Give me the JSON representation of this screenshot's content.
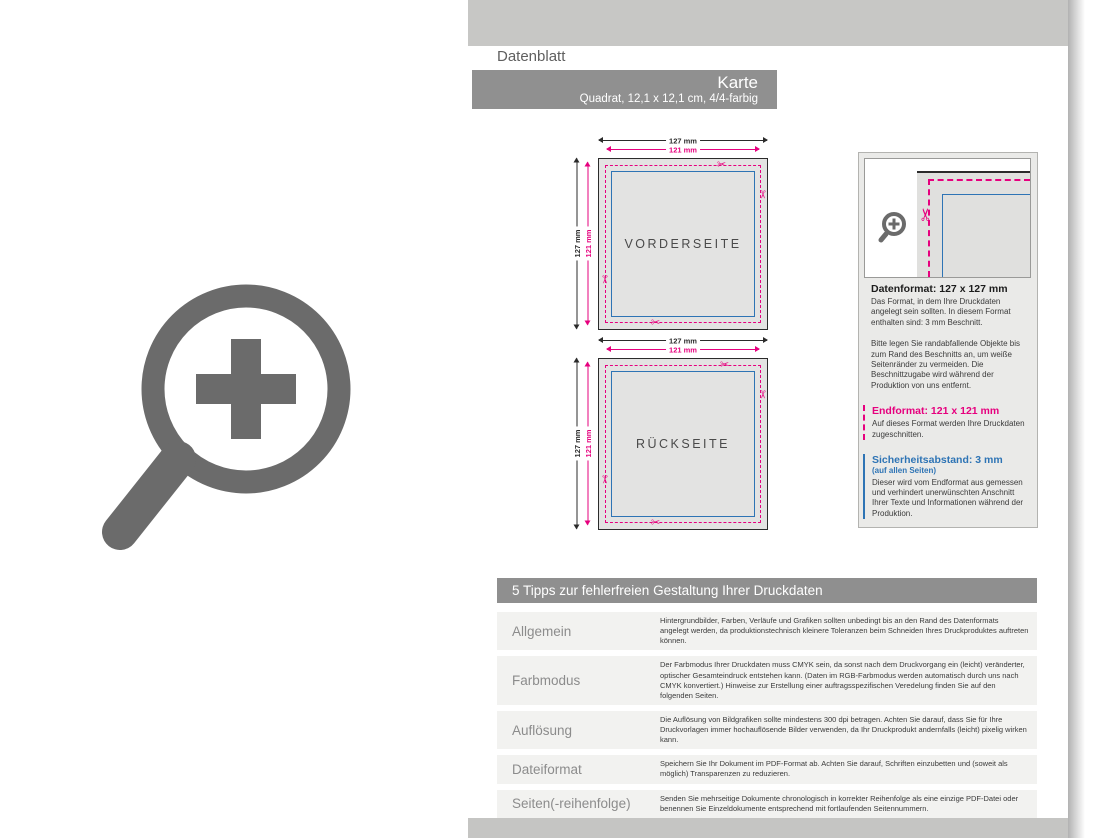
{
  "page": {
    "tab_label": "Datenblatt",
    "product": {
      "title": "Karte",
      "subtitle": "Quadrat, 12,1 x 12,1 cm, 4/4-farbig"
    }
  },
  "icons": {
    "scissors": "✂",
    "magnifier_plus": "zoom-plus"
  },
  "colors": {
    "cut_magenta": "#e6007e",
    "safety_blue": "#2e74b5",
    "band_gray": "#c7c7c5",
    "bar_gray": "#909090",
    "icon_gray": "#6b6b6b"
  },
  "diagrams": {
    "front": {
      "label": "VORDERSEITE",
      "width_outer": "127 mm",
      "width_inner": "121 mm",
      "height_outer": "127 mm",
      "height_inner": "121 mm"
    },
    "back": {
      "label": "RÜCKSEITE",
      "width_outer": "127 mm",
      "width_inner": "121 mm",
      "height_outer": "127 mm",
      "height_inner": "121 mm"
    }
  },
  "info_panel": {
    "datenformat": {
      "heading": "Datenformat: 127 x 127 mm",
      "body1": "Das Format, in dem Ihre Druckdaten angelegt sein sollten. In diesem Format enthalten sind: 3 mm Beschnitt.",
      "body2": "Bitte legen Sie randabfallende Objekte bis zum Rand des Beschnitts an, um weiße Seitenränder zu vermeiden. Die Beschnittzugabe wird während der Produktion von uns entfernt."
    },
    "endformat": {
      "heading": "Endformat: 121 x 121 mm",
      "body": "Auf dieses Format werden Ihre Druckdaten zugeschnitten."
    },
    "sicherheitsabstand": {
      "heading": "Sicherheitsabstand: 3 mm",
      "subheading": "(auf allen Seiten)",
      "body": "Dieser wird vom Endformat aus gemessen und verhindert unerwünschten Anschnitt Ihrer Texte und Informationen während der Produktion."
    }
  },
  "tips": {
    "header": "5 Tipps zur fehlerfreien Gestaltung Ihrer Druckdaten",
    "rows": [
      {
        "label": "Allgemein",
        "text": "Hintergrundbilder, Farben, Verläufe und Grafiken sollten unbedingt bis an den Rand des Datenformats angelegt werden, da produktionstechnisch kleinere Toleranzen beim Schneiden Ihres Druckproduktes auftreten können."
      },
      {
        "label": "Farbmodus",
        "text": "Der Farbmodus Ihrer Druckdaten muss CMYK sein, da sonst nach dem Druckvorgang ein (leicht) veränderter, optischer Gesamteindruck entstehen kann. (Daten im RGB-Farbmodus werden automatisch durch uns nach CMYK konvertiert.) Hinweise zur Erstellung einer auftragsspezifischen Veredelung finden Sie auf den folgenden Seiten."
      },
      {
        "label": "Auflösung",
        "text": "Die Auflösung von Bildgrafiken sollte mindestens 300 dpi betragen. Achten Sie darauf, dass Sie für Ihre Druckvorlagen immer hochauflösende Bilder verwenden, da Ihr Druckprodukt andernfalls (leicht) pixelig wirken kann."
      },
      {
        "label": "Dateiformat",
        "text": "Speichern Sie Ihr Dokument im PDF-Format ab. Achten Sie darauf, Schriften einzubetten und (soweit als möglich) Transparenzen zu reduzieren."
      },
      {
        "label": "Seiten(-reihenfolge)",
        "text": "Senden Sie mehrseitige Dokumente chronologisch in korrekter Reihenfolge als eine einzige PDF-Datei oder benennen Sie Einzeldokumente entsprechend mit fortlaufenden Seitennummern."
      }
    ]
  }
}
